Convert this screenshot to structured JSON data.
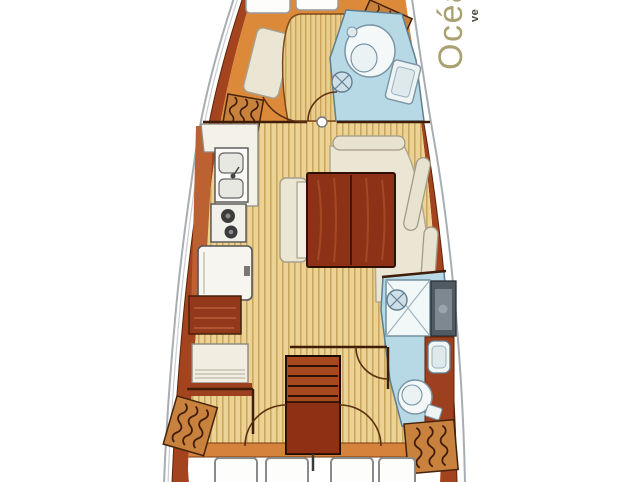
{
  "branding": {
    "name_visible": "Océa",
    "subtext_visible": "ve"
  },
  "colors": {
    "hull_outline": "#a8adb2",
    "hull_band": "#a3441e",
    "hull_band_edge": "#5f2409",
    "forward_floor": "#dc8a3a",
    "sole_base": "#ecd393",
    "sole_stripe": "#c9a75f",
    "bed_base": "#e9cd8d",
    "bed_stripe": "#cba45c",
    "wet_area": "#b7d9e6",
    "fixture_white": "#f4f8f8",
    "fixture_line": "#6a8a9a",
    "furniture_cream": "#ebe6d4",
    "furniture_cream_line": "#b2a98f",
    "table_wood": "#8e3217",
    "table_wood_line": "#2e1104",
    "steps_wood": "#a8481f",
    "locker_wood": "#c8823e",
    "locker_grain": "#45220a",
    "galley_counter_strip": "#bc6132",
    "nav_cabinet": "#93381b",
    "aft_counter": "#9c4020",
    "shower_counter_dark": "#4f5a63",
    "shower_counter_light": "#7d8890",
    "orange_strip": "#d4823c",
    "wall_line": "#3f1d08",
    "door_arc": "#5d3012",
    "cushion_white": "#fdfdfb",
    "cushion_line": "#8a8a8a",
    "brand_text": "#a9a172",
    "brand_subtext": "#4a463c"
  },
  "diagram": {
    "type": "sailboat-interior-floor-plan",
    "orientation": "bow-at-top",
    "regions": [
      "forward-cabin",
      "forward-head",
      "saloon",
      "galley",
      "nav-station",
      "companionway",
      "aft-head",
      "aft-lockers",
      "cockpit-cushions"
    ]
  }
}
